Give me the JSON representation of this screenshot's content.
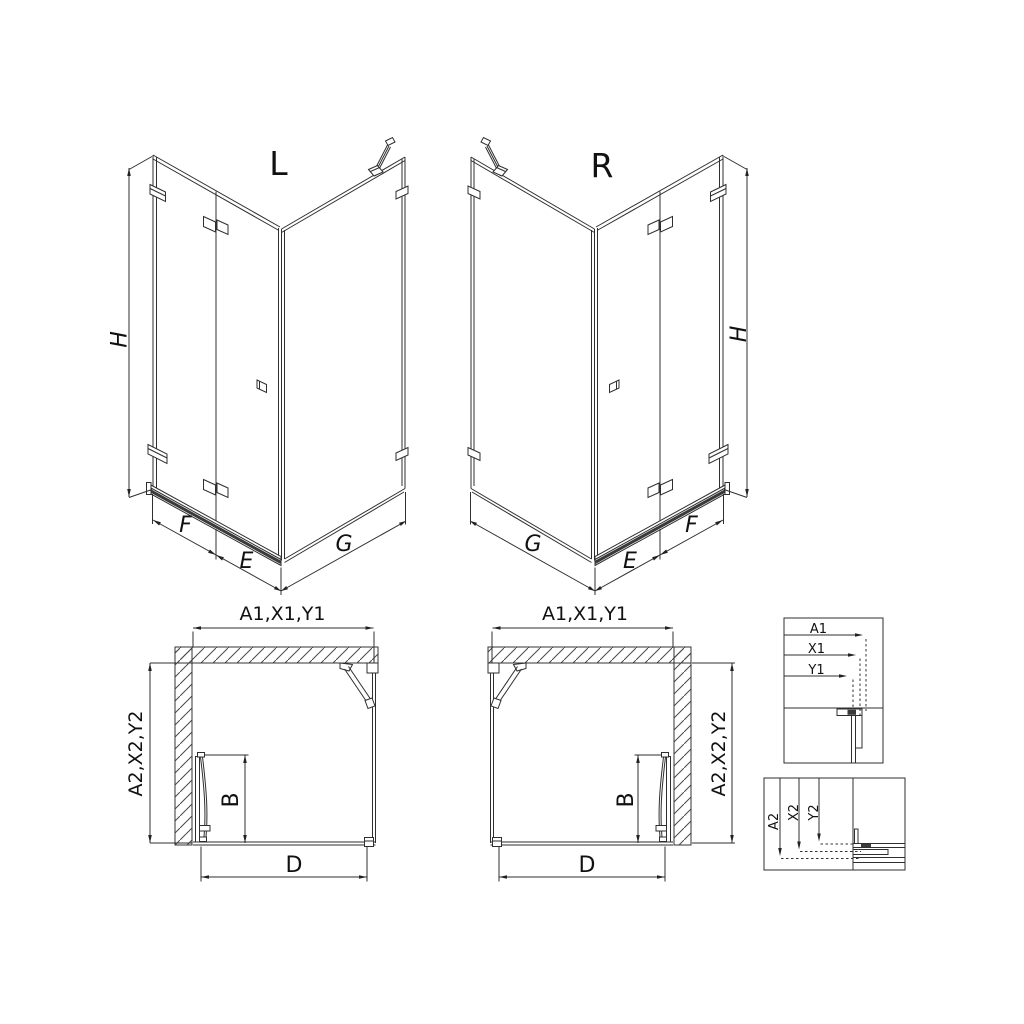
{
  "drawing": {
    "type": "shower-enclosure-technical-drawing",
    "colors": {
      "line": "#2f2f2f",
      "text": "#111111",
      "background": "#ffffff",
      "hatch": "#4a4a4a"
    }
  },
  "iso_left": {
    "title": "L",
    "height": "H",
    "fixed_panel": "F",
    "door_panel": "E",
    "side_panel": "G"
  },
  "iso_right": {
    "title": "R",
    "height": "H",
    "fixed_panel": "F",
    "door_panel": "E",
    "side_panel": "G"
  },
  "plan_left": {
    "width_dims": "A1,X1,Y1",
    "depth_dims": "A2,X2,Y2",
    "door_width": "B",
    "opening_width": "D"
  },
  "plan_right": {
    "width_dims": "A1,X1,Y1",
    "depth_dims": "A2,X2,Y2",
    "door_width": "B",
    "opening_width": "D"
  },
  "detail_width": {
    "dims": [
      "A1",
      "X1",
      "Y1"
    ]
  },
  "detail_depth": {
    "dims": [
      "A2",
      "X2",
      "Y2"
    ]
  }
}
